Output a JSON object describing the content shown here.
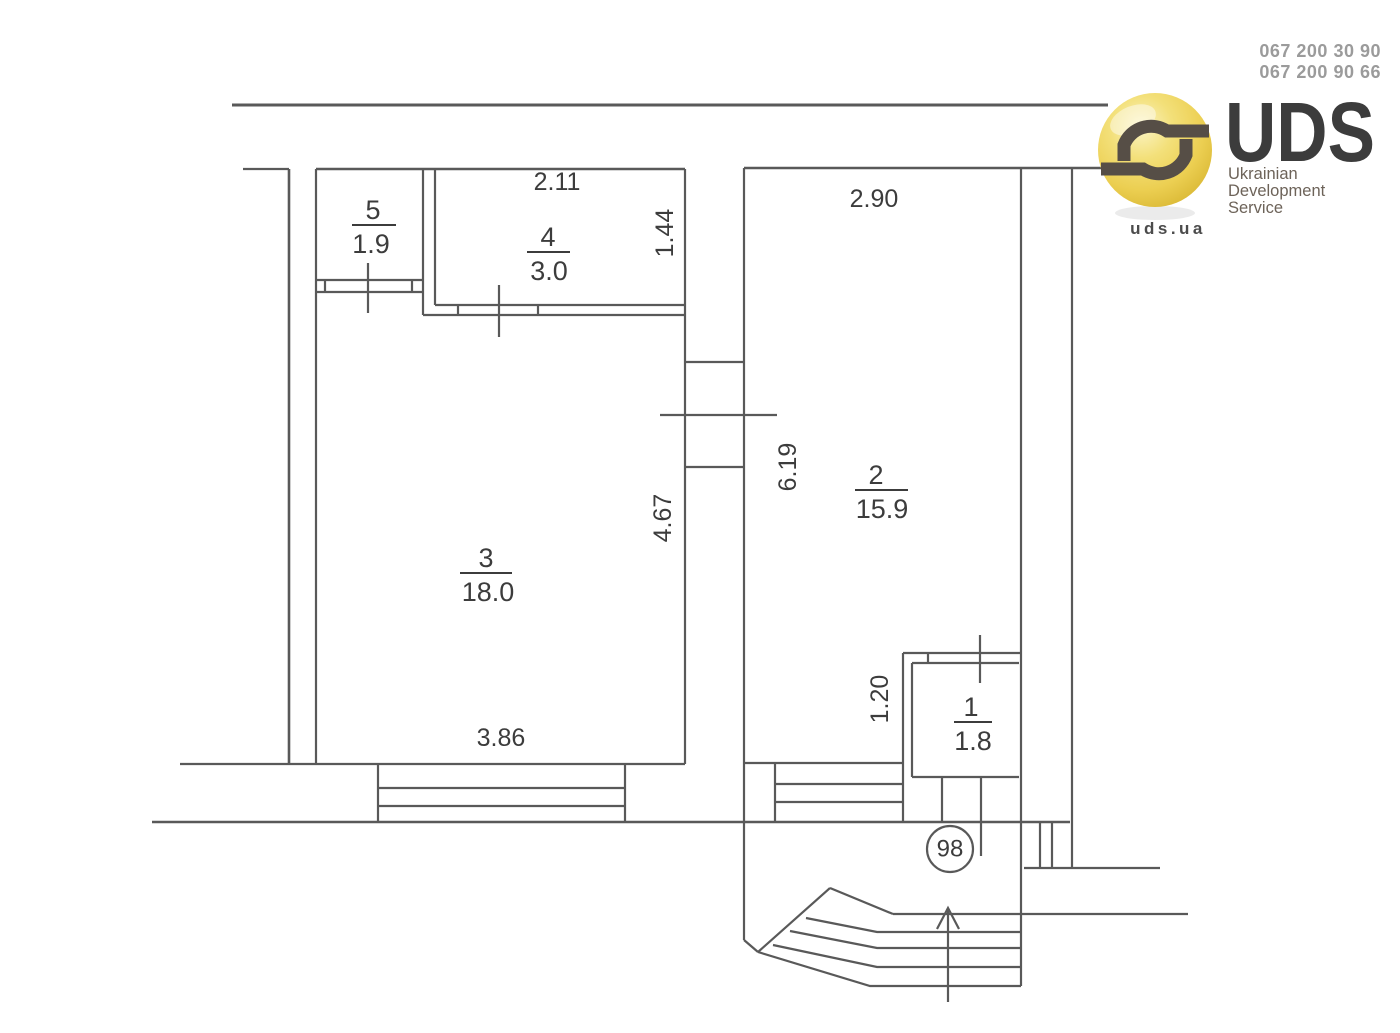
{
  "contact": {
    "phone_1": "067 200 30 90",
    "phone_2": "067 200 90 66"
  },
  "logo": {
    "acronym": "UDS",
    "tagline": [
      "Ukrainian",
      "Development",
      "Service"
    ],
    "website": "uds.ua",
    "colors": {
      "ball_yellow": "#eccf52",
      "swirl_brown": "#564e46",
      "text_brown": "#6d6359",
      "phone_gray": "#9b9b9b"
    }
  },
  "floor_plan": {
    "apartment_number": "98",
    "line_color": "#595959",
    "text_color": "#3c3c3c",
    "rooms": [
      {
        "number": "5",
        "area": "1.9"
      },
      {
        "number": "4",
        "area": "3.0"
      },
      {
        "number": "3",
        "area": "18.0"
      },
      {
        "number": "2",
        "area": "15.9"
      },
      {
        "number": "1",
        "area": "1.8"
      }
    ],
    "dimensions": {
      "top_width": "2.11",
      "top_depth": "1.44",
      "room2_width": "2.90",
      "room2_height": "6.19",
      "room3_height": "4.67",
      "room3_width": "3.86",
      "niche_height": "1.20"
    }
  }
}
